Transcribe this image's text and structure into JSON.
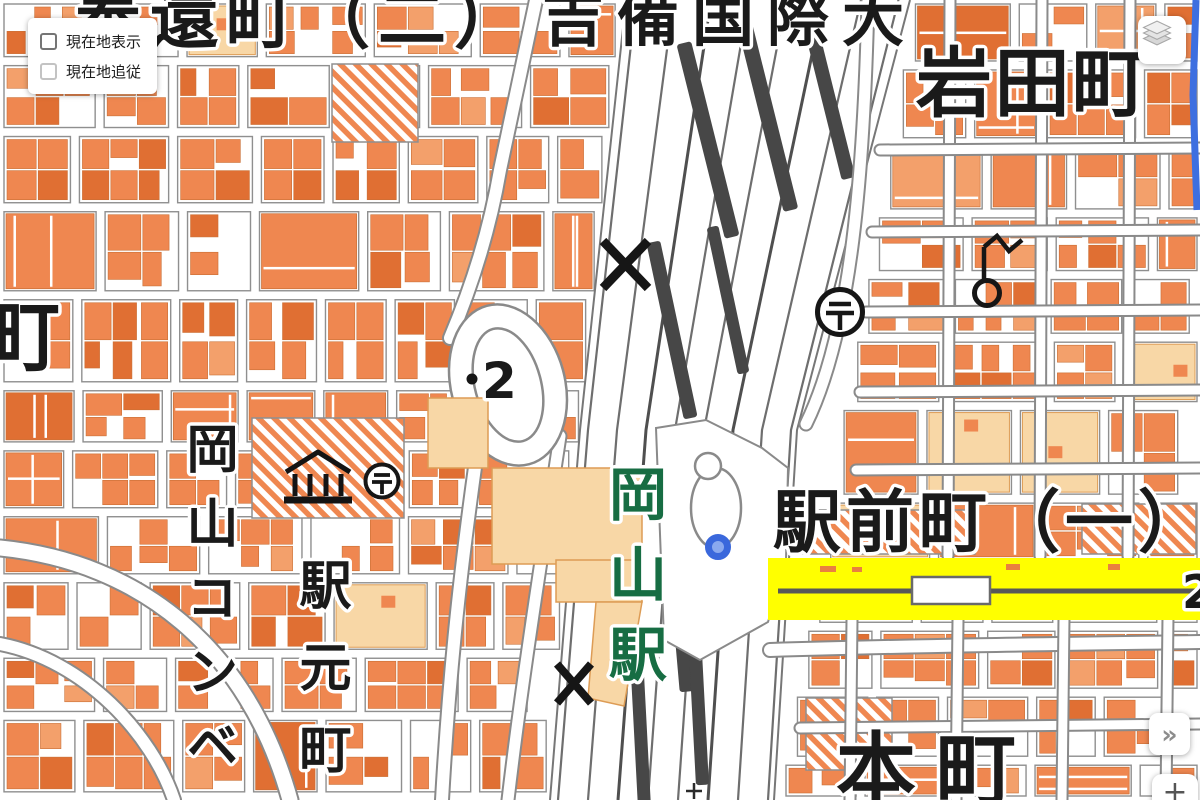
{
  "map": {
    "labels": {
      "hokancho": "奉還町（二）",
      "kibi_university": "吉備国際大",
      "iwatacho": "岩田町",
      "cut_left_cho": "町",
      "ekimaecho": "駅前町（一）",
      "honmachi": "本町",
      "station": "岡山駅",
      "okayama_conve": "岡山コンベ",
      "ekimotocho": "駅元町",
      "elevation_value": "2",
      "route_number": "2"
    },
    "symbols": {
      "post_office": "〒 post office (circle)",
      "police_box": "X koban / police box",
      "museum": "museum (temple front)",
      "weather_station": "weather station (wind vane)",
      "elevation_point": "spot elevation dot",
      "point_marker": "blue point marker",
      "grid_cross": "+"
    },
    "colors": {
      "building": "#ef8750",
      "building_dark": "#e06f33",
      "building_light": "#f3a06b",
      "block_outline": "#8f8f8f",
      "peach": "#f8d7a6",
      "peach_outline": "#dd9c55",
      "rail_track": "#6e6e6e",
      "rail_track_dark": "#4f4f4f",
      "rail_platform": "#474747",
      "road_casing": "#8a8a8a",
      "highlight_yellow": "#ffff00",
      "station_green": "#176d43",
      "marker_blue": "#3a68dc",
      "marker_blue_fill": "#8aa9ef",
      "water_blue": "#3d6fe0"
    }
  },
  "controls": {
    "show_location": {
      "label": "現在地表示",
      "checked": false
    },
    "follow_location": {
      "label": "現在地追従",
      "checked": false,
      "disabled": true
    },
    "expand_button": {
      "glyph": "»"
    },
    "zoom_in_button": {
      "glyph": "+"
    }
  }
}
